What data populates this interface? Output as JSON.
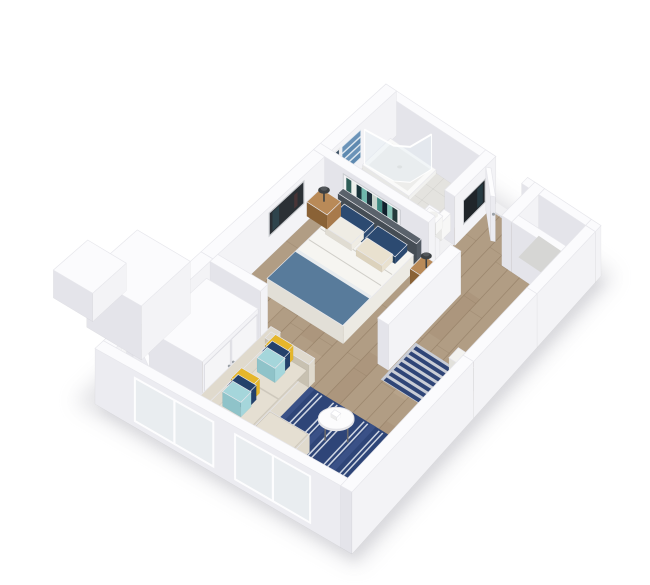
{
  "scene": {
    "type": "3d-floor-plan-render",
    "background": "#ffffff",
    "rooms": [
      {
        "name": "bathroom"
      },
      {
        "name": "entry"
      },
      {
        "name": "hallway"
      },
      {
        "name": "bedroom"
      },
      {
        "name": "closet"
      },
      {
        "name": "living-room"
      }
    ],
    "items": [
      "shower",
      "towel-rack",
      "bathroom-mirror",
      "vanity",
      "toilet",
      "front-door",
      "entry-niche",
      "entry-artwork",
      "bed",
      "headboard",
      "nightstand-left",
      "nightstand-right",
      "lamp-left",
      "lamp-right",
      "bedroom-art-above-bed",
      "bedroom-art-left",
      "closet-sliding-doors",
      "side-door",
      "kitchen-counter",
      "counter-stool",
      "sofa",
      "sofa-pillows",
      "living-room-rug",
      "hallway-runner-rug",
      "coffee-table",
      "plant-1",
      "plant-2",
      "windows"
    ],
    "palette": {
      "background": "#ffffff",
      "shadow": "#bfbfc6",
      "shadow2": "#c9c9cf",
      "wallTop": "#fbfbfd",
      "wallLit": "#f3f3f6",
      "wallShade": "#e4e4ea",
      "wallOuterLit": "#f6f6f8",
      "topStroke": "#e7e7ec",
      "faceStroke": "rgba(0,0,0,0.05)",
      "floorWood": "#b19d84",
      "plankSeam": "rgba(130,108,84,0.45)",
      "plankTintDark": "rgba(150,124,96,0.18)",
      "plankTintLight": "rgba(208,190,164,0.20)",
      "bathTile": "#e4e3df",
      "tileSeam": "rgba(0,0,0,0.06)",
      "threshold": "#f1f1f3",
      "rugNavy": "#2e4578",
      "rugNavyLight": "#3a5187",
      "rugStripe": "#cfd6e2",
      "runnerBase": "#c9cdd6",
      "runnerBar": "#2f4577",
      "doorLit": "#f8f8fa",
      "doorShade": "#ebebf0",
      "doorTop": "#fdfdfe",
      "handle": "#9aa0a6",
      "counterTop": "#6e665c",
      "counterSide": "#57504a",
      "counterEdge": "#4e4842",
      "counterItem": "#fafafa",
      "stool": "#f3f2ef",
      "headboardLit": "#525a63",
      "headboardShade": "#454d55",
      "headboardTop": "#5a626b",
      "mattress": "#f6f5f1",
      "mattressLit": "#eceae3",
      "mattressShade": "#e2dfd7",
      "crease": "rgba(120,115,105,0.30)",
      "throw": "#587b9b",
      "throwStripe": "#e8ecef",
      "pillowNavy": "#2c4a71",
      "pillowNavyShade": "#24405f",
      "pillowWhite": "#efece4",
      "pillowCream": "#e9e1cf",
      "nsTop": "#b98a58",
      "nsLit": "#a87a4b",
      "nsShade": "#8a6236",
      "lampDark": "#3c4043",
      "lampMid": "#54585c",
      "towelA": "#6b93b8",
      "towelB": "#5e89b0",
      "towelEdge": "rgba(222,232,240,0.9)",
      "mirror": "#3a4f63",
      "mirrorFrame": "#e8e8ea",
      "artAboveFrame": "#f2f2f4",
      "artStripes": [
        "#2e5d57",
        "#ecf0ec",
        "#173339",
        "#6fb7ab",
        "#20303b",
        "#c9d4cd",
        "#3f8a81",
        "#10202c",
        "#88c4b8",
        "#243b3c"
      ],
      "artLeftBg": "#2b3035",
      "artLeftAccent1": "#31525c",
      "artLeftAccent2": "#6d3a37",
      "artFrameLight": "#caccd0",
      "artHallBg": "#20252a",
      "artHallAccent": "#2e4f58",
      "showerBase": "#fafaf9",
      "showerTray": "#ededeb",
      "glassFill": "rgba(228,238,245,0.40)",
      "glassEdge": "rgba(255,255,255,0.92)",
      "fixtureWhite": "#f7f7f6",
      "fixtureTop": "#fcfcfc",
      "basin": "#e9e9e9",
      "sofaBase": "#d9d3c6",
      "sofaLit": "#e0dacd",
      "sofaShade": "#c8c1b1",
      "sofaCushion": "#e5dfd2",
      "cushSeam": "rgba(0,0,0,0.07)",
      "pillowYellow": "#e5b62b",
      "pillowYellowShade": "#caa01f",
      "pillowTeal": "#a5d6db",
      "pillowTealShade": "#8fc3c9",
      "sofaNavy": "#24416b",
      "sofaNavyShade": "#1d3659",
      "tableTop": "#fcfcfd",
      "tableRim": "#e7e7ea",
      "tableLeg": "#6a6a6e",
      "tableStroke": "#e3e3e7",
      "plantGreen": "#4d7c40",
      "plantGreenDark": "#3a6132",
      "plantGreenLight": "#5e9150",
      "pot": "#f5f5f4",
      "windowPane": "#e9edf0",
      "windowFrame": "#fdfdfe"
    },
    "patterns": {
      "runner_bar_count": 7,
      "rug_pinstripe_groups": [
        106,
        121,
        136,
        151,
        166,
        181
      ],
      "rug_tone_bands": [
        [
          112,
          117
        ],
        [
          142,
          147
        ],
        [
          172,
          177
        ]
      ],
      "towel_band_count": 4
    }
  }
}
